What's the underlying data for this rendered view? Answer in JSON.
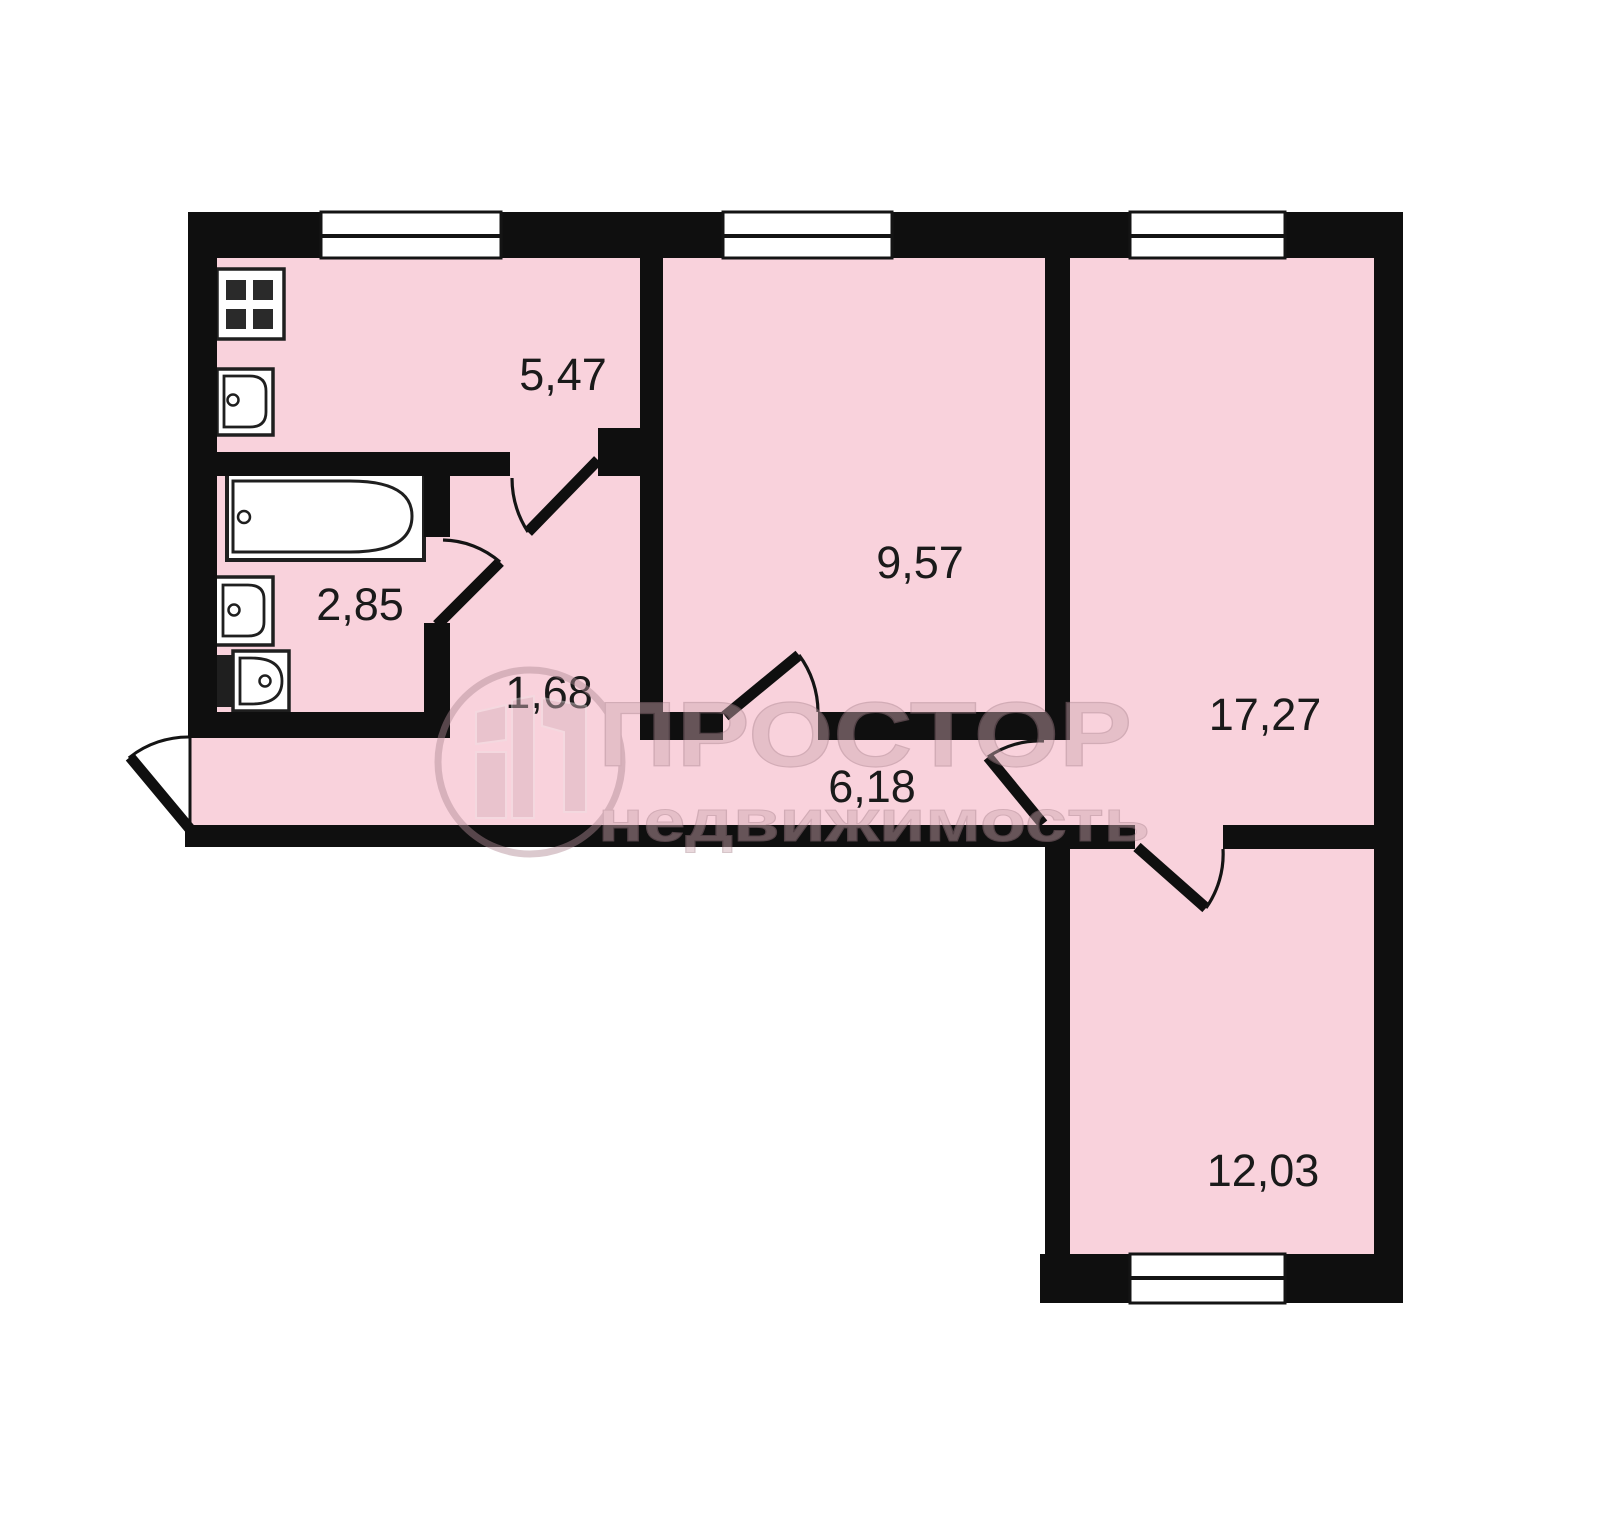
{
  "plan_type": "apartment-floor-plan",
  "rooms": {
    "kitchen": {
      "area": "5,47"
    },
    "room_upper": {
      "area": "9,57"
    },
    "bathroom": {
      "area": "2,85"
    },
    "entry_hall": {
      "area": "1,68"
    },
    "corridor": {
      "area": "6,18"
    },
    "room_right": {
      "area": "17,27"
    },
    "room_lower": {
      "area": "12,03"
    }
  },
  "watermark": {
    "brand": "ПРОСТОР",
    "tagline": "недвижимость"
  },
  "colors": {
    "floor": "#f9d2dc",
    "walls": "#0f0f0f",
    "background": "#ffffff",
    "label_text": "#1a1a1a",
    "watermark_tone": "#cfa9b2"
  },
  "fixtures": [
    "stove-icon",
    "kitchen-sink-icon",
    "bathtub-icon",
    "washbasin-icon",
    "toilet-icon"
  ]
}
